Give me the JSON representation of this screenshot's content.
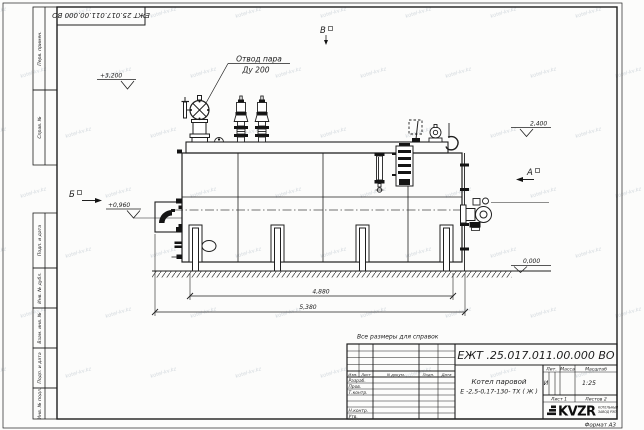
{
  "page": {
    "stamp_number_top": "ЕЖТ 25.017.011.00.000  ВО",
    "format_label": "Формат А3",
    "note": "Все размеры для справок",
    "watermark": "kotel-kv.kz"
  },
  "margin_labels": {
    "perv_primen": "Перв. примен.",
    "sprav_no": "Справ. №",
    "podp_data_1": "Подп. и дата",
    "inv_dubl": "Инв. № дубл.",
    "vzam_inv": "Взам. инв. №",
    "podp_data_2": "Подп. и дата",
    "inv_podl": "Инв. № подл."
  },
  "drawing": {
    "callout_line1": "Отвод пара",
    "callout_line2": "Ду 200",
    "elevations": {
      "top": "+3,200",
      "right": "2,400",
      "door": "+0,960",
      "ground": "0,000"
    },
    "views": {
      "left": "Б",
      "right": "А",
      "top": "В"
    },
    "dimensions": {
      "inner": "4,880",
      "overall": "5,380"
    }
  },
  "title_block": {
    "doc_number": "ЕЖТ .25.017.011.00.000  ВО",
    "product_name_1": "Котел паровой",
    "product_name_2": "Е -2,5-0,17-130- ТХ ( Ж )",
    "headers": {
      "izm": "Изм.",
      "list": "Лист",
      "docum": "N докум.",
      "podp": "Подп.",
      "data": "Дата"
    },
    "rows": {
      "razrab": "Разраб.",
      "prov": "Пров.",
      "tkontr": "Т.контр.",
      "nkontr": "Н.контр.",
      "utv": "Утв."
    },
    "lit_header": "Лит.",
    "massa_header": "Масса",
    "masshtab_header": "Масштаб",
    "lit_value": "И",
    "scale_value": "1:25",
    "sheet_label": "Лист 1",
    "sheets_label": "Листов 2",
    "logo_text": "KVZR",
    "logo_sub_1": "КОТЕЛЬНЫЙ",
    "logo_sub_2": "ЗАВОД РЭП"
  }
}
